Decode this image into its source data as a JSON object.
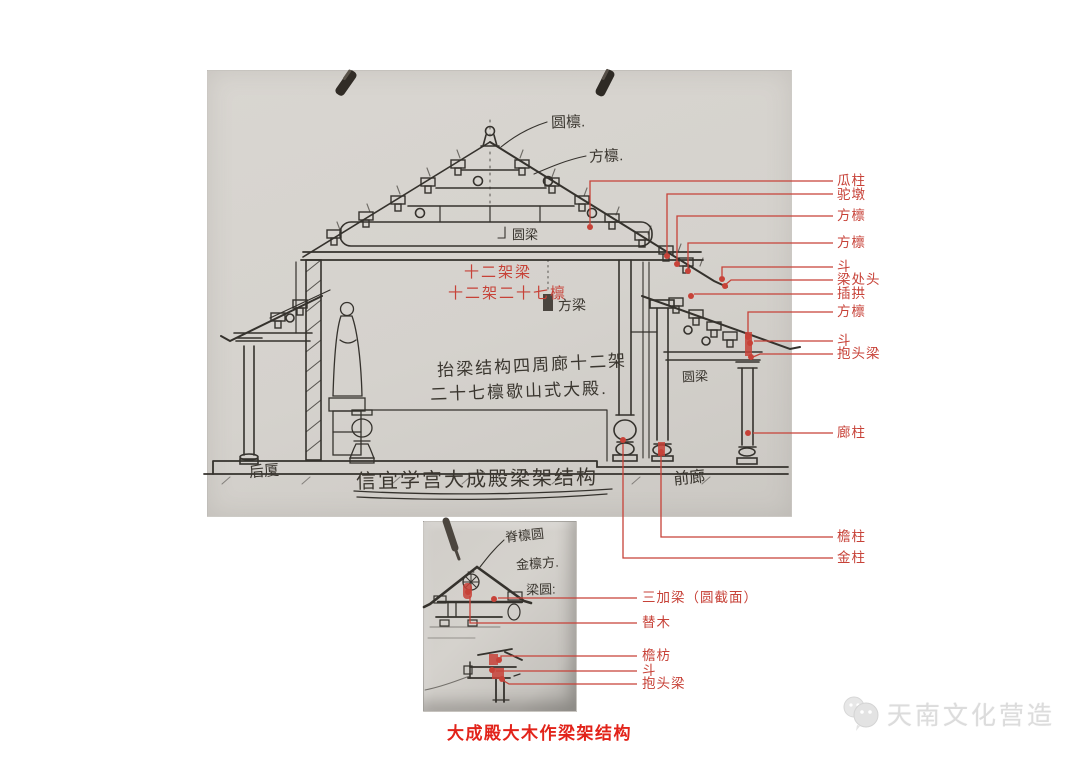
{
  "colors": {
    "annotation_red": "#c74238",
    "caption_red": "#e2231a",
    "ink": "#3a362f",
    "paper_gray": "#d5d2cd"
  },
  "main_sketch": {
    "ink_labels": {
      "round_purlin": "圆檩.",
      "square_purlin": "方檩.",
      "round_beam": "圆梁",
      "square_beam": "方梁",
      "round_beam_porch": "圆梁",
      "note_line1": "抬梁结构四周廊十二架",
      "note_line2": "二十七檩歇山式大殿.",
      "title": "信宜学宫大成殿梁架结构",
      "rear_porch": "后厦",
      "front_porch": "前廊"
    },
    "red_notes": {
      "line1": "十二架梁",
      "line2": "十二架二十七檩"
    },
    "right_labels": [
      "瓜柱",
      "驼墩",
      "方檩",
      "方檩",
      "斗",
      "梁处头",
      "插拱",
      "方檩",
      "斗",
      "抱头梁",
      "廊柱",
      "檐柱",
      "金柱"
    ]
  },
  "detail_sketch": {
    "ink_labels": {
      "ridge_purlin": "脊檩圆",
      "gold_purlin": "金檩方.",
      "beam_round": "梁圆:"
    },
    "red_labels": [
      "三加梁（圆截面）",
      "替木",
      "檐枋",
      "斗",
      "抱头梁"
    ]
  },
  "caption": "大成殿大木作梁架结构",
  "watermark": {
    "icon": "wechat-logo-icon",
    "text": "天南文化营造"
  }
}
